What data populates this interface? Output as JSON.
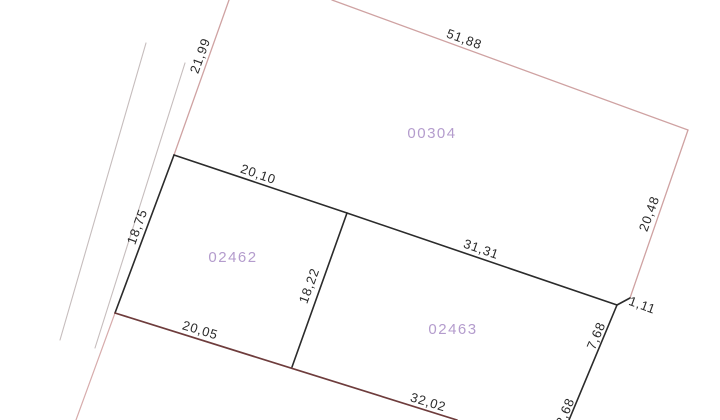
{
  "map": {
    "background": "#ffffff",
    "parcel_labels": {
      "p00304": "00304",
      "p02462": "02462",
      "p02463": "02463"
    },
    "dimensions": {
      "d21_99": "21,99",
      "d51_88": "51,88",
      "d20_10": "20,10",
      "d18_75": "18,75",
      "d18_22": "18,22",
      "d31_31": "31,31",
      "d20_48": "20,48",
      "d1_11": "1,11",
      "d7_68": "7,68",
      "d20_05": "20,05",
      "d32_02": "32,02",
      "d2_68": "2,68"
    },
    "colors": {
      "parcel_boundary": "#2b2b2b",
      "outer_boundary_pink": "#cfa2a2",
      "road_edge_gray": "#c6bdbd",
      "road_edge_pink": "#d7acac",
      "road_boundary_dark": "#6e3c3c",
      "dimension_text": "#2a2a2a",
      "parcel_id_text": "#b49ccd"
    }
  }
}
